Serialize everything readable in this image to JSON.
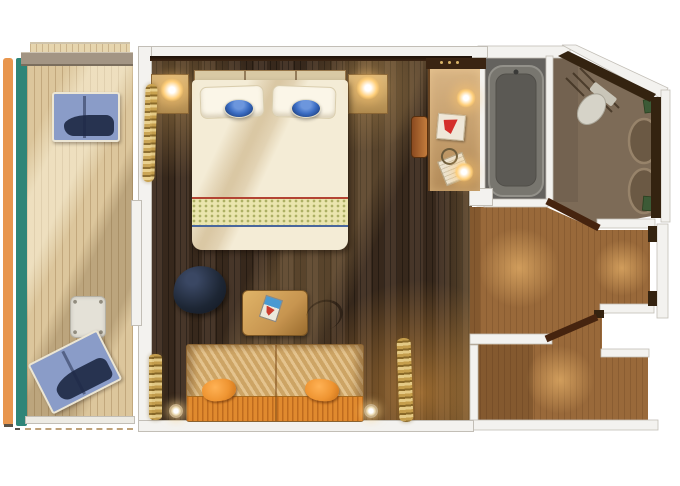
{
  "scene": {
    "type": "floor-plan",
    "subject": "cruise-ship balcony stateroom, top-down rendered floor plan, no text labels",
    "rooms": [
      {
        "name": "balcony",
        "features": [
          "wood deck planking",
          "orange hull strip",
          "teal trim strip",
          "balcony divider partition",
          "blue lounge chair (top)",
          "blue lounge chair (bottom, angled)",
          "small white side table",
          "railing with dashed deck edge"
        ]
      },
      {
        "name": "bedroom-living",
        "features": [
          "king bed with cream bedding",
          "two white pillows",
          "two blue bowls on bed",
          "patterned runner band with red and blue trim",
          "headboard",
          "two nightstands with lit lamps",
          "gold curtains at balcony door",
          "dark navy round armchair",
          "wood writing desk with blue-red booklet",
          "desk chair outline",
          "orange striped sofa with two orange pillows",
          "two round wall sconces",
          "dark walnut plank flooring"
        ]
      },
      {
        "name": "vanity-corner",
        "features": [
          "vanity counter",
          "shelf with bottles",
          "two lit vanity lamps",
          "red logo bag",
          "rope-handle tote bag",
          "brown vanity chair"
        ]
      },
      {
        "name": "bathroom",
        "features": [
          "bathtub in gray wet section",
          "white divider wall",
          "angled toilet",
          "vent grill lines",
          "double round sinks",
          "two green towels",
          "angled outer wall"
        ]
      },
      {
        "name": "entry-hall",
        "features": [
          "angled corridor with glow lighting",
          "open dark-wood door leaves",
          "entry vestibule with cabin door jambs",
          "closet nook"
        ]
      }
    ]
  },
  "colors": {
    "page_bg": "#ffffff",
    "wall_white": "#f3f2ef",
    "wall_edge": "#c2beb6",
    "orange_strip": "#e8964e",
    "teal_strip": "#2f8578",
    "deck": "#dcc69c",
    "deck_top": "#e6d5ae",
    "deck_plank": "#b08c58",
    "partition": "#a39584",
    "railing": "#edebe4",
    "lounge_blue": "#8a9cc8",
    "lounge_navy": "#273350",
    "lounge_frame": "#ece6d4",
    "table_white": "#e4e1d7",
    "room_floor": "#402e20",
    "nightstand": "#c9a469",
    "lamp_glow": "#ffcf7a",
    "headboard": "#d9c9a4",
    "bed_cream": "#f4ecd6",
    "pillow_white": "#fbf6e8",
    "bowl_blue": "#3a6cc2",
    "bowl_navy": "#1e3f7e",
    "runner": "#eae5ae",
    "runner_red": "#b34433",
    "runner_blue": "#49679c",
    "curtain_gold": "#c9a24e",
    "curtain_dark": "#8a6a28",
    "chair_navy": "#1d2634",
    "desk": "#c79550",
    "desk_item_blue": "#4a9ad2",
    "desk_item_red": "#cc3a2e",
    "sofa_back": "#d9b273",
    "sofa_seat": "#e08a2e",
    "pillow_orange": "#ef9532",
    "sconce_ring": "#c8b088",
    "vanity_shelf": "#3a2412",
    "vanity_chair": "#a8622e",
    "bag_cream": "#efe7d8",
    "bag_red": "#d42f2a",
    "tote": "#ece4d2",
    "bath_floor": "#7d6b57",
    "tub_section": "#64625e",
    "tub": "#78766f",
    "tub_inner": "#5b5954",
    "toilet": "#d6d3c8",
    "sink": "#6b5944",
    "sink_rim": "#97836a",
    "towel_green": "#3c5a36",
    "bath_wall_dark": "#342310",
    "hall_floor": "#99693a",
    "hall_glow": "#e8a85a",
    "door_leaf": "#46240f"
  }
}
